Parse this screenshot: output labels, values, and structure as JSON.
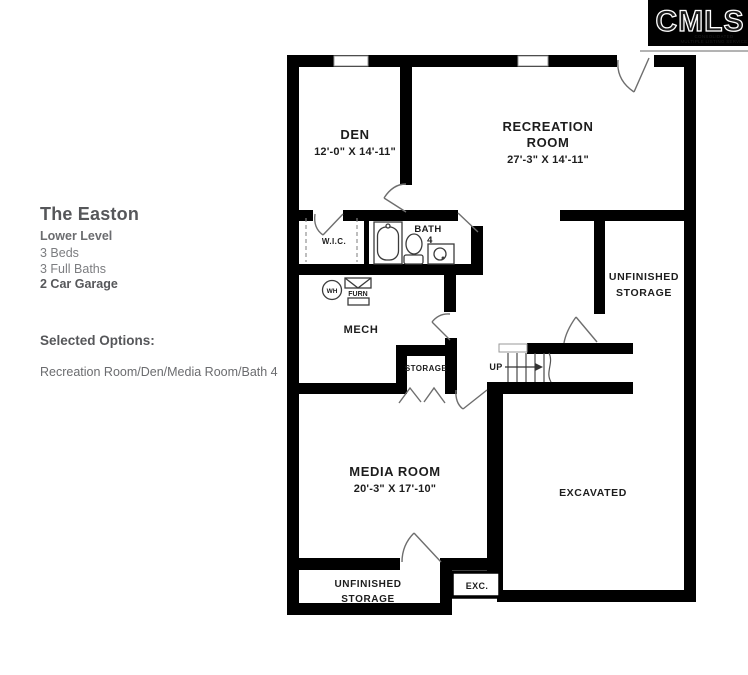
{
  "logo": {
    "brand": "CMLS",
    "tagline_line1": "CONSOLIDATED",
    "tagline_line2": "MULTIPLE LISTING SERVICE"
  },
  "info_panel": {
    "plan_name": "The Easton",
    "level": "Lower Level",
    "beds": "3 Beds",
    "baths": "3 Full Baths",
    "garage": "2 Car Garage",
    "selected_options_label": "Selected Options:",
    "selected_options_value": "Recreation Room/Den/Media Room/Bath 4"
  },
  "floor_plan": {
    "rooms": {
      "den": {
        "name": "DEN",
        "dims": "12'-0\" X 14'-11\""
      },
      "recreation": {
        "name_line1": "RECREATION",
        "name_line2": "ROOM",
        "dims": "27'-3\" X 14'-11\""
      },
      "wic": {
        "name": "W.I.C."
      },
      "bath": {
        "name_line1": "BATH",
        "name_line2": "4"
      },
      "unfinished_storage_right": {
        "name_line1": "UNFINISHED",
        "name_line2": "STORAGE"
      },
      "mech": {
        "name": "MECH"
      },
      "storage": {
        "name": "STORAGE"
      },
      "stairs": {
        "label": "UP"
      },
      "media": {
        "name": "MEDIA ROOM",
        "dims": "20'-3\" X 17'-10\""
      },
      "excavated": {
        "name": "EXCAVATED"
      },
      "unfinished_storage_bottom": {
        "name_line1": "UNFINISHED",
        "name_line2": "STORAGE"
      },
      "exc": {
        "name": "EXC."
      }
    },
    "fixtures": {
      "water_heater": "WH",
      "furnace": "FURN"
    }
  },
  "colors": {
    "wall": "#000000",
    "logo_bg": "#000000",
    "door_line": "#666666",
    "dark_text": "#56575a",
    "muted_text": "#6b6c6f"
  }
}
